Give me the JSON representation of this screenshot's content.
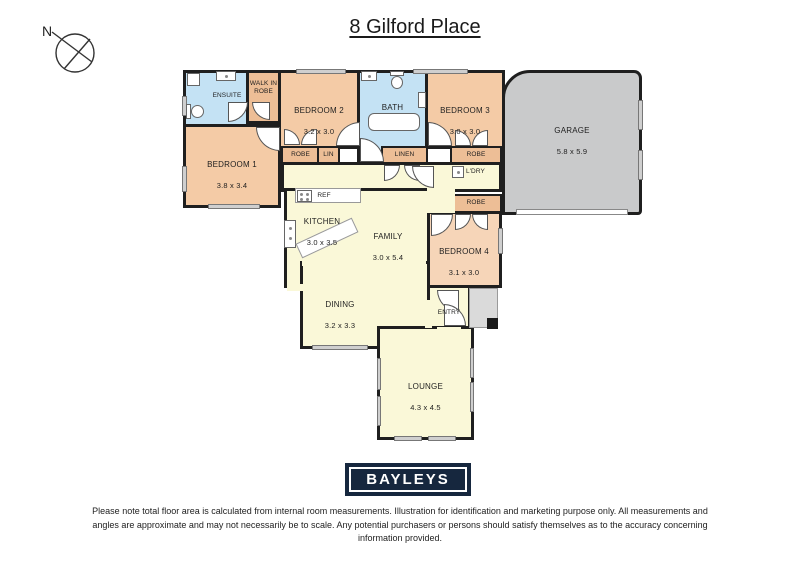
{
  "title": "8 Gilford Place",
  "compass": {
    "north": "N"
  },
  "rooms": {
    "ensuite": {
      "name": "ENSUITE"
    },
    "walk_in_robe": {
      "name": "WALK IN\nROBE"
    },
    "bedroom2": {
      "name": "BEDROOM 2",
      "dims": "3.2 x 3.0"
    },
    "bath": {
      "name": "BATH"
    },
    "bedroom3": {
      "name": "BEDROOM 3",
      "dims": "3.0 x 3.0"
    },
    "garage": {
      "name": "GARAGE",
      "dims": "5.8 x 5.9"
    },
    "bedroom1": {
      "name": "BEDROOM 1",
      "dims": "3.8 x 3.4"
    },
    "kitchen": {
      "name": "KITCHEN",
      "dims": "3.0 x 3.5"
    },
    "family": {
      "name": "FAMILY",
      "dims": "3.0 x 5.4"
    },
    "bedroom4": {
      "name": "BEDROOM 4",
      "dims": "3.1 x 3.0"
    },
    "dining": {
      "name": "DINING",
      "dims": "3.2 x 3.3"
    },
    "entry": {
      "name": "ENTRY"
    },
    "lounge": {
      "name": "LOUNGE",
      "dims": "4.3 x 4.5"
    },
    "robe_bedroom2": {
      "name": "ROBE"
    },
    "lin": {
      "name": "LIN"
    },
    "linen": {
      "name": "LINEN"
    },
    "robe_bedroom3": {
      "name": "ROBE"
    },
    "robe_bedroom4": {
      "name": "ROBE"
    },
    "laundry": {
      "name": "L'DRY"
    },
    "fridge": {
      "name": "REF"
    }
  },
  "logo": {
    "text": "BAYLEYS"
  },
  "disclaimer": "Please note total floor area is calculated from internal room measurements. Illustration for identification and marketing purpose only. All measurements and angles are approximate and may not necessarily be to scale. Any potential purchasers or persons should satisfy themselves as to the accuracy concerning information provided.",
  "colors": {
    "bedroom": "#F4CBA6",
    "bedroom4": "#F6D5B8",
    "robe": "#EDBE96",
    "wet_area": "#C4E2F4",
    "living": "#FAF8D8",
    "garage": "#C9CACB",
    "wall": "#1F1F1F",
    "logo_navy": "#16273E"
  }
}
